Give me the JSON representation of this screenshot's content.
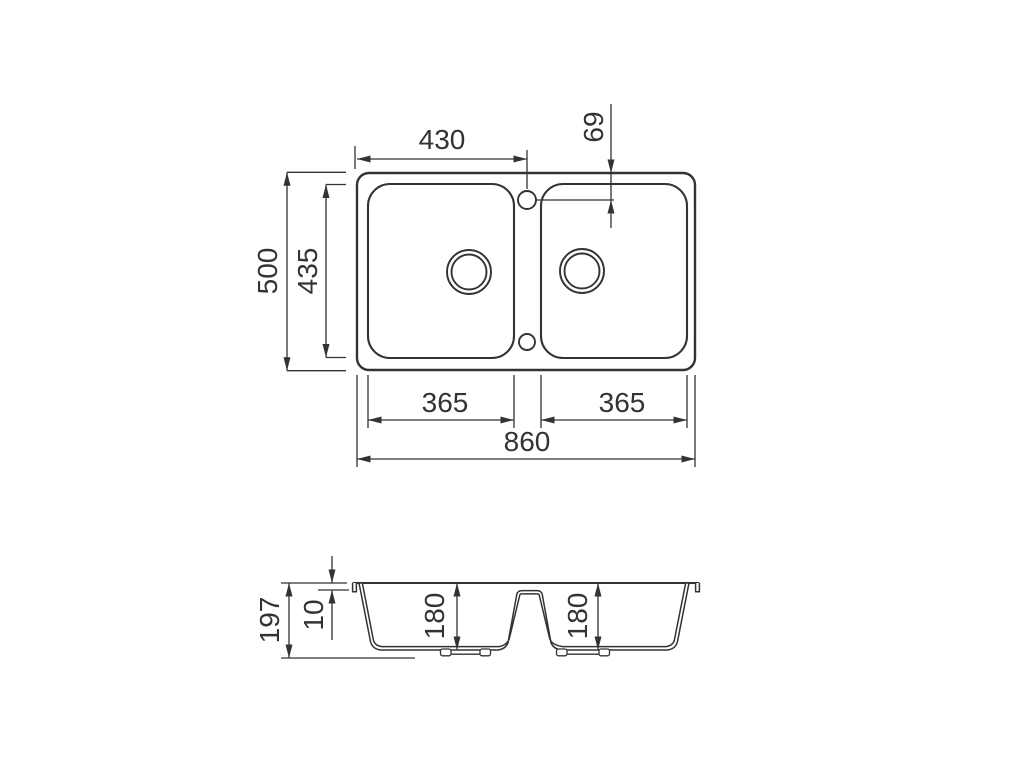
{
  "drawing": {
    "top_view": {
      "dim_tap_centre_from_left": "430",
      "dim_tap_centre_from_back": "69",
      "dim_overall_depth": "500",
      "dim_bowl_inner_depth": "435",
      "dim_left_bowl_width": "365",
      "dim_right_bowl_width": "365",
      "dim_overall_width": "860"
    },
    "section_view": {
      "dim_overall_height": "197",
      "dim_rim_thickness": "10",
      "dim_left_bowl_depth": "180",
      "dim_right_bowl_depth": "180"
    },
    "colors": {
      "line": "#333333",
      "background": "#ffffff"
    }
  }
}
